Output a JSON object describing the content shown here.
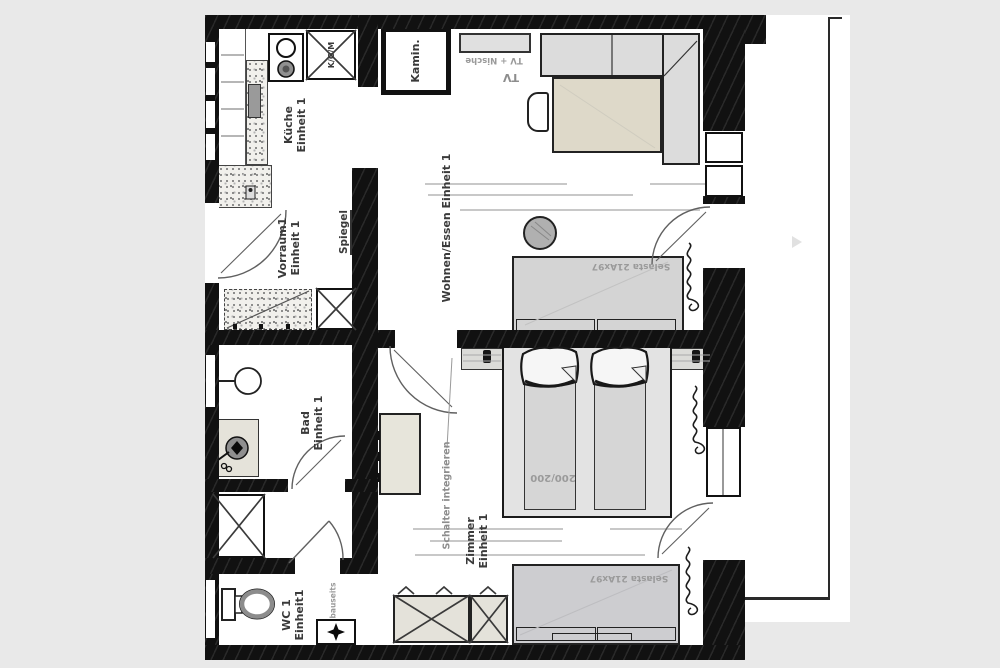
{
  "plan": {
    "colors": {
      "background": "#e9e9e9",
      "floor": "#ffffff",
      "wall": "#111111",
      "furniture_gray": "#d4d4d4",
      "furniture_beige": "#ded9c9"
    },
    "rooms": {
      "kitchen": {
        "name_line1": "Küche",
        "name_line2": "Einheit 1",
        "appliance_box": "K/G/M"
      },
      "fireplace": {
        "name": "Kamin."
      },
      "living": {
        "name": "Wohnen/Essen Einheit 1",
        "tv_niche": "TV + Nische",
        "tv": "TV",
        "sideboard": "Selasta 21Ax97"
      },
      "vestibule": {
        "name_line1": "Vorraum1",
        "name_line2": "Einheit 1",
        "mirror": "Spiegel"
      },
      "bathroom": {
        "name_line1": "Bad",
        "name_line2": "Einheit 1"
      },
      "wc": {
        "name_line1": "WC 1",
        "name_line2": "Einheit1",
        "note": "bauseits"
      },
      "bedroom": {
        "name_line1": "Zimmer",
        "name_line2": "Einheit 1",
        "bed_size": "200/200",
        "sofa": "Selasta 21Ax97",
        "switch_note": "Schalter integrieren"
      }
    }
  }
}
